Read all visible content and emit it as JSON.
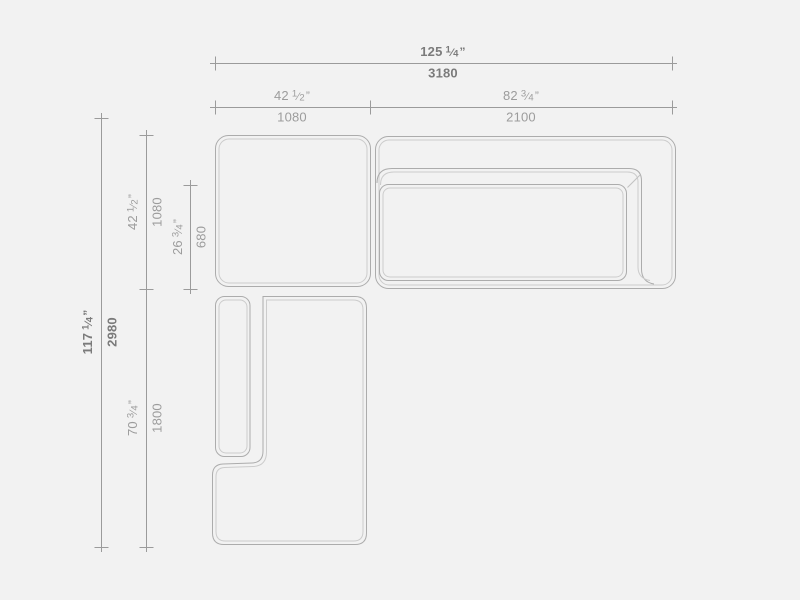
{
  "canvas": {
    "width": 800,
    "height": 600,
    "background": "#f2f2f2"
  },
  "style": {
    "dim_line_color": "#9b9b9b",
    "dim_text_color": "#9c9c9c",
    "dim_text_strong_color": "#7b7b7b",
    "outline_color": "#acacac",
    "outline_inner_color": "#cccccc"
  },
  "glyphs": {
    "fraction_slash": "⁄",
    "inch_mark": "”"
  },
  "dimensions": {
    "overall_width": {
      "in_whole": "125",
      "in_num": "1",
      "in_den": "4",
      "mm": "3180",
      "inches_value": 125.25,
      "mm_value": 3180,
      "orientation": "horizontal",
      "emphasis": "strong"
    },
    "left_module_width": {
      "in_whole": "42",
      "in_num": "1",
      "in_den": "2",
      "mm": "1080",
      "inches_value": 42.5,
      "mm_value": 1080,
      "orientation": "horizontal",
      "emphasis": "normal"
    },
    "right_module_width": {
      "in_whole": "82",
      "in_num": "3",
      "in_den": "4",
      "mm": "2100",
      "inches_value": 82.75,
      "mm_value": 2100,
      "orientation": "horizontal",
      "emphasis": "normal"
    },
    "overall_height": {
      "in_whole": "117",
      "in_num": "1",
      "in_den": "4",
      "mm": "2980",
      "inches_value": 117.25,
      "mm_value": 2980,
      "orientation": "vertical",
      "emphasis": "strong"
    },
    "top_module_height": {
      "in_whole": "42",
      "in_num": "1",
      "in_den": "2",
      "mm": "1080",
      "inches_value": 42.5,
      "mm_value": 1080,
      "orientation": "vertical",
      "emphasis": "normal"
    },
    "seat_depth": {
      "in_whole": "26",
      "in_num": "3",
      "in_den": "4",
      "mm": "680",
      "inches_value": 26.75,
      "mm_value": 680,
      "orientation": "vertical",
      "emphasis": "normal"
    },
    "bottom_module_height": {
      "in_whole": "70",
      "in_num": "3",
      "in_den": "4",
      "mm": "1800",
      "inches_value": 70.75,
      "mm_value": 1800,
      "orientation": "vertical",
      "emphasis": "normal"
    }
  }
}
